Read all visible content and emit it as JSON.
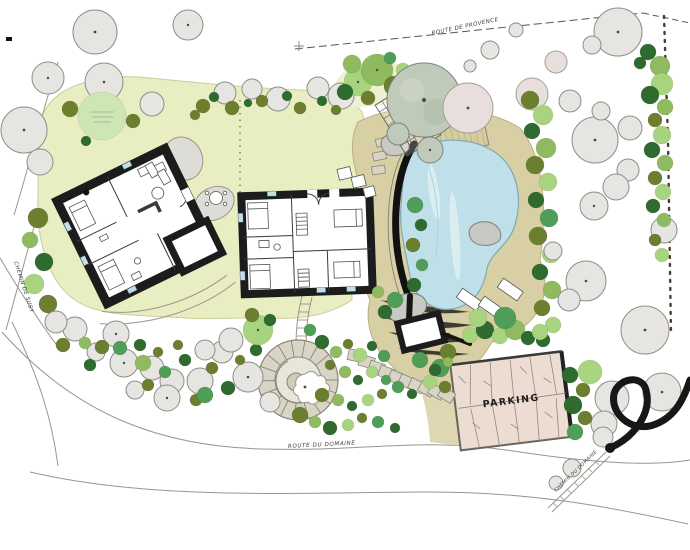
{
  "plan": {
    "type": "hand-drawn landscape site plan",
    "labels": {
      "parking": "PARKING",
      "road_top": "ROUTE DE PROVENCE",
      "road_bottom": "ROUTE DU DOMAINE",
      "road_left": "CHEMIN DE SUSY",
      "road_bottom_right": "CHEMIN DU DOMAINE",
      "north_mark": "+"
    },
    "features": [
      "main-house-floorplan",
      "guest-house-floorplan",
      "swimming-pool",
      "pool-deck",
      "pergola-trellis",
      "pool-house",
      "parking-lot",
      "spiral-stone-path",
      "stepping-stone-path",
      "lawn",
      "tree-groves",
      "boundary-hedge",
      "sun-loungers",
      "garden-table"
    ]
  },
  "colors": {
    "lawn": "#e9edc2",
    "lawn_light": "#eef0d2",
    "pool": "#bfe0e8",
    "pool_light": "#daeef2",
    "terrace": "#d8d0a4",
    "deck": "#d5cd9e",
    "parking": "#ecdcd2",
    "stone": "#d8d4c6",
    "stone_dark": "#8a8578",
    "building_wall": "#1c1c1c",
    "building_fill": "#ffffff",
    "grey_tree": "#e6e5e1",
    "grey_tree_stroke": "#8d8d89",
    "canopy_grey_green": "#c0cabb",
    "tree_dark_olive": "#6b7f2e",
    "tree_deep_green": "#2f6b2f",
    "tree_mid_green": "#4f9e57",
    "tree_light_green": "#a8d47f",
    "tree_pale_green": "#cde6b4",
    "tree_pink": "#e8dfdc",
    "hedge_black": "#171717",
    "road_line": "#9a968e",
    "label": "#3c3c3c"
  }
}
